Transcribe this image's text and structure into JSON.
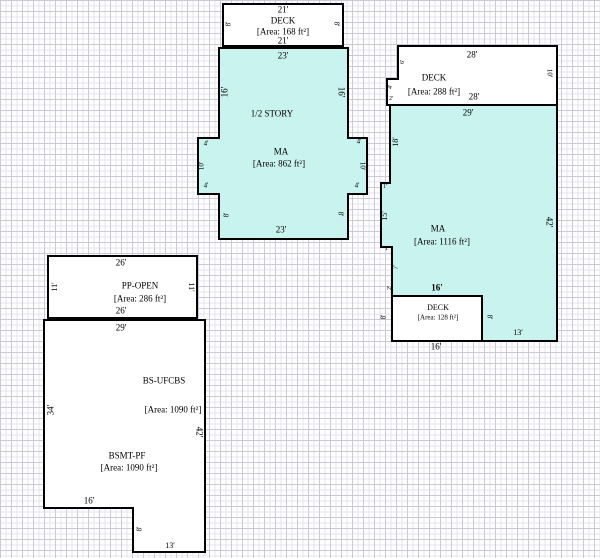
{
  "sketch_title": "property-sketch",
  "colors": {
    "room_fill": "#c9f3ee",
    "deck_fill": "#ffffff",
    "outline": "#000000",
    "grid_minor": "#e3e3ee",
    "grid_major": "#c9c9da",
    "text": "#000000"
  },
  "structures": {
    "upper_deck": {
      "label": "DECK",
      "area_label": "[Area: 168 ft²]"
    },
    "half_story": {
      "label_story": "1/2 STORY",
      "label": "MA",
      "area_label": "[Area: 862 ft²]"
    },
    "right_deck": {
      "label": "DECK",
      "area_label": "[Area: 288 ft²]"
    },
    "right_main": {
      "label": "MA",
      "area_label": "[Area: 1116 ft²]"
    },
    "right_deck_cut": {
      "label": "DECK",
      "area_label": "[Area: 128 ft²]"
    },
    "porch_open": {
      "label": "PP-OPEN",
      "area_label": "[Area: 286 ft²]"
    },
    "basement": {
      "label": "BS-UFCBS",
      "area_label": "[Area: 1090 ft²]",
      "label2": "BSMT-PF",
      "area_label2": "[Area: 1090 ft²]"
    }
  },
  "annotations": [
    {
      "name": "dim-top-deck-top",
      "text": "21'",
      "x": 283,
      "y": 10,
      "size": 9
    },
    {
      "name": "room-label",
      "text": "DECK",
      "x": 283,
      "y": 21,
      "size": 9
    },
    {
      "name": "area-label",
      "text": "[Area: 168 ft²]",
      "x": 283,
      "y": 32,
      "size": 9
    },
    {
      "name": "dim-top-deck-bottom",
      "text": "21'",
      "x": 283,
      "y": 41,
      "size": 9
    },
    {
      "name": "dim-top-deck-left",
      "text": "8'",
      "x": 229,
      "y": 24,
      "size": 7,
      "rot": -90
    },
    {
      "name": "dim-top-deck-right",
      "text": "8'",
      "x": 336,
      "y": 24,
      "size": 7,
      "rot": 90
    },
    {
      "name": "dim-halfstory-top",
      "text": "23'",
      "x": 283,
      "y": 56,
      "size": 9
    },
    {
      "name": "dim-halfstory-left",
      "text": "16'",
      "x": 225,
      "y": 92,
      "size": 9,
      "rot": -90
    },
    {
      "name": "dim-halfstory-right",
      "text": "16'",
      "x": 341,
      "y": 92,
      "size": 9,
      "rot": 90
    },
    {
      "name": "room-label",
      "text": "1/2 STORY",
      "x": 272,
      "y": 114,
      "size": 9
    },
    {
      "name": "room-label",
      "text": "MA",
      "x": 281,
      "y": 152,
      "size": 9
    },
    {
      "name": "area-label",
      "text": "[Area: 862 ft²]",
      "x": 279,
      "y": 164,
      "size": 9
    },
    {
      "name": "dim-left-bump-top",
      "text": "4'",
      "x": 206,
      "y": 144,
      "size": 7
    },
    {
      "name": "dim-left-bump-side",
      "text": "10'",
      "x": 202,
      "y": 166,
      "size": 7,
      "rot": -90
    },
    {
      "name": "dim-left-bump-bottom",
      "text": "4'",
      "x": 206,
      "y": 186,
      "size": 7
    },
    {
      "name": "dim-right-bump-top",
      "text": "4'",
      "x": 359,
      "y": 142,
      "size": 7
    },
    {
      "name": "dim-right-bump-side",
      "text": "10'",
      "x": 362,
      "y": 166,
      "size": 7,
      "rot": 90
    },
    {
      "name": "dim-right-bump-bottom",
      "text": "4'",
      "x": 357,
      "y": 186,
      "size": 7
    },
    {
      "name": "dim-halfstory-left-lower",
      "text": "8'",
      "x": 227,
      "y": 215,
      "size": 7,
      "rot": -90
    },
    {
      "name": "dim-halfstory-right-lower",
      "text": "8'",
      "x": 340,
      "y": 214,
      "size": 7,
      "rot": 90
    },
    {
      "name": "dim-halfstory-bottom",
      "text": "23'",
      "x": 281,
      "y": 230,
      "size": 9
    },
    {
      "name": "dim-right-deck-top",
      "text": "28'",
      "x": 472,
      "y": 55,
      "size": 9
    },
    {
      "name": "room-label",
      "text": "DECK",
      "x": 434,
      "y": 78,
      "size": 9
    },
    {
      "name": "area-label",
      "text": "[Area: 288 ft²]",
      "x": 434,
      "y": 92,
      "size": 9
    },
    {
      "name": "dim-right-deck-bottom",
      "text": "28'",
      "x": 474,
      "y": 97,
      "size": 9
    },
    {
      "name": "dim-right-deck-right",
      "text": "10'",
      "x": 549,
      "y": 73,
      "size": 7,
      "rot": 90
    },
    {
      "name": "dim-right-deck-notch-a",
      "text": "6'",
      "x": 403,
      "y": 62,
      "size": 6,
      "rot": -90
    },
    {
      "name": "dim-right-deck-notch-b",
      "text": "4'",
      "x": 391,
      "y": 87,
      "size": 6,
      "rot": -90
    },
    {
      "name": "dim-right-deck-notch-c",
      "text": "2'",
      "x": 391,
      "y": 99,
      "size": 6
    },
    {
      "name": "dim-right-ma-top",
      "text": "29'",
      "x": 468,
      "y": 113,
      "size": 9
    },
    {
      "name": "dim-right-ma-right",
      "text": "42'",
      "x": 549,
      "y": 222,
      "size": 9,
      "rot": 90
    },
    {
      "name": "dim-right-ma-left-1",
      "text": "18'",
      "x": 396,
      "y": 142,
      "size": 8,
      "rot": -90
    },
    {
      "name": "dim-right-ma-step-1",
      "text": "1'",
      "x": 385,
      "y": 187,
      "size": 6
    },
    {
      "name": "dim-right-ma-left-2",
      "text": "15'",
      "x": 385,
      "y": 216,
      "size": 8,
      "rot": -90
    },
    {
      "name": "dim-right-ma-step-2",
      "text": "1'",
      "x": 387,
      "y": 249,
      "size": 6
    },
    {
      "name": "dim-right-ma-left-3",
      "text": "7'",
      "x": 396,
      "y": 267,
      "size": 7,
      "rot": -90
    },
    {
      "name": "dim-right-ma-left-4",
      "text": "2'",
      "x": 390,
      "y": 288,
      "size": 6,
      "rot": -90
    },
    {
      "name": "room-label",
      "text": "MA",
      "x": 438,
      "y": 229,
      "size": 9
    },
    {
      "name": "area-label",
      "text": "[Area: 1116 ft²]",
      "x": 442,
      "y": 242,
      "size": 9
    },
    {
      "name": "dim-deck-cut-top",
      "text": "16'",
      "x": 437,
      "y": 288,
      "size": 9,
      "bold": true
    },
    {
      "name": "room-label",
      "text": "DECK",
      "x": 438,
      "y": 308,
      "size": 8
    },
    {
      "name": "area-label",
      "text": "[Area: 128 ft²]",
      "x": 438,
      "y": 318,
      "size": 7
    },
    {
      "name": "dim-deck-cut-left",
      "text": "8'",
      "x": 384,
      "y": 317,
      "size": 7,
      "rot": -90
    },
    {
      "name": "dim-deck-cut-right",
      "text": "8'",
      "x": 489,
      "y": 317,
      "size": 7,
      "rot": 90
    },
    {
      "name": "dim-right-ma-bottom",
      "text": "13'",
      "x": 518,
      "y": 333,
      "size": 8
    },
    {
      "name": "dim-deck-cut-bottom",
      "text": "16'",
      "x": 436,
      "y": 347,
      "size": 9
    },
    {
      "name": "dim-ppopen-top",
      "text": "26'",
      "x": 121,
      "y": 263,
      "size": 9
    },
    {
      "name": "dim-ppopen-left",
      "text": "11'",
      "x": 55,
      "y": 287,
      "size": 8,
      "rot": -90
    },
    {
      "name": "dim-ppopen-right",
      "text": "11'",
      "x": 191,
      "y": 287,
      "size": 8,
      "rot": 90
    },
    {
      "name": "room-label",
      "text": "PP-OPEN",
      "x": 140,
      "y": 286,
      "size": 9
    },
    {
      "name": "area-label",
      "text": "[Area: 286 ft²]",
      "x": 140,
      "y": 299,
      "size": 9
    },
    {
      "name": "dim-ppopen-bottom",
      "text": "26'",
      "x": 121,
      "y": 311,
      "size": 9
    },
    {
      "name": "dim-basement-top",
      "text": "29'",
      "x": 121,
      "y": 328,
      "size": 9
    },
    {
      "name": "dim-basement-left",
      "text": "34'",
      "x": 51,
      "y": 410,
      "size": 9,
      "rot": -90
    },
    {
      "name": "dim-basement-right",
      "text": "42'",
      "x": 199,
      "y": 432,
      "size": 9,
      "rot": 90
    },
    {
      "name": "room-label",
      "text": "BS-UFCBS",
      "x": 164,
      "y": 381,
      "size": 9
    },
    {
      "name": "area-label",
      "text": "[Area: 1090 ft²]",
      "x": 173,
      "y": 410,
      "size": 9
    },
    {
      "name": "room-label",
      "text": "BSMT-PF",
      "x": 127,
      "y": 456,
      "size": 9
    },
    {
      "name": "area-label",
      "text": "[Area: 1090 ft²]",
      "x": 129,
      "y": 468,
      "size": 9
    },
    {
      "name": "dim-basement-step-top",
      "text": "16'",
      "x": 89,
      "y": 501,
      "size": 9
    },
    {
      "name": "dim-basement-step-side",
      "text": "8'",
      "x": 140,
      "y": 529,
      "size": 7,
      "rot": -90
    },
    {
      "name": "dim-basement-bottom",
      "text": "13'",
      "x": 170,
      "y": 546,
      "size": 8
    }
  ]
}
